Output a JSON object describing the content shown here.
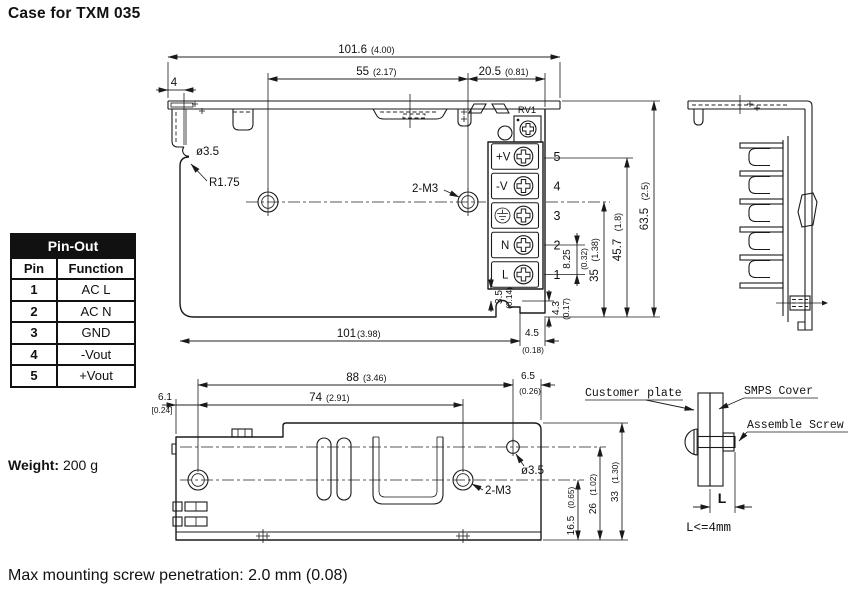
{
  "title": "Case for TXM 035",
  "pinout": {
    "title": "Pin-Out",
    "col_pin": "Pin",
    "col_function": "Function",
    "rows": [
      {
        "pin": "1",
        "function": "AC L"
      },
      {
        "pin": "2",
        "function": "AC N"
      },
      {
        "pin": "3",
        "function": "GND"
      },
      {
        "pin": "4",
        "function": "-Vout"
      },
      {
        "pin": "5",
        "function": "+Vout"
      }
    ]
  },
  "weight": {
    "label": "Weight:",
    "value": "200 g"
  },
  "footnote": "Max mounting screw penetration: 2.0 mm (0.08)",
  "colors": {
    "line": "#1a1a1a",
    "table_header_bg": "#111111",
    "table_header_text": "#ffffff"
  },
  "icons": {
    "terminal_screw": "phillips-screw-icon",
    "ground_terminal": "earth-ground-icon",
    "trimpot": "trimpot-icon",
    "led": "led-icon"
  },
  "front_view": {
    "dim_overall_width_mm": "101.6",
    "dim_overall_width_in": "(4.00)",
    "dim_hole_span_mm": "55",
    "dim_hole_span_in": "(2.17)",
    "dim_hole_to_edge_mm": "20.5",
    "dim_hole_to_edge_in": "(0.81)",
    "dim_flange_mm": "4",
    "label_hole_dia": "ø3.5",
    "label_corner_radius": "R1.75",
    "label_mounting_holes": "2-M3",
    "label_trimpot": "RV1",
    "dim_body_width_mm": "101",
    "dim_body_width_in": "(3.98)",
    "dim_notch_offset_mm": "4.5",
    "dim_notch_offset_in": "(0.18)",
    "dim_notch_mm": "3.5",
    "dim_notch_in": "(0.14)",
    "dim_step_mm": "4.3",
    "dim_step_in": "(0.17)",
    "dim_pitch_mm": "8.25",
    "dim_pitch_in": "(0.32)",
    "dim_35_mm": "35",
    "dim_35_in": "(1.38)",
    "dim_457_mm": "45.7",
    "dim_457_in": "(1.8)",
    "dim_height_mm": "63.5",
    "dim_height_in": "(2.5)",
    "terminals": [
      {
        "label": "+V",
        "pin": "5"
      },
      {
        "label": "-V",
        "pin": "4"
      },
      {
        "label": "",
        "pin": "3"
      },
      {
        "label": "N",
        "pin": "2"
      },
      {
        "label": "L",
        "pin": "1"
      }
    ]
  },
  "bottom_view": {
    "dim_88_mm": "88",
    "dim_88_in": "(3.46)",
    "dim_74_mm": "74",
    "dim_74_in": "(2.91)",
    "dim_61_mm": "6.1",
    "dim_61_in": "[0.24]",
    "dim_65_mm": "6.5",
    "dim_65_in": "(0.26)",
    "label_hole_dia": "ø3.5",
    "label_mounting_holes": "2-M3",
    "dim_165_mm": "16.5",
    "dim_165_in": "(0.65)",
    "dim_26_mm": "26",
    "dim_26_in": "(1.02)",
    "dim_33_mm": "33",
    "dim_33_in": "(1.30)"
  },
  "assembly_detail": {
    "label_customer_plate": "Customer plate",
    "label_smps_cover": "SMPS Cover",
    "label_assemble_screw": "Assemble Screw",
    "dim_l_label": "L",
    "note_l_max": "L<=4mm"
  }
}
